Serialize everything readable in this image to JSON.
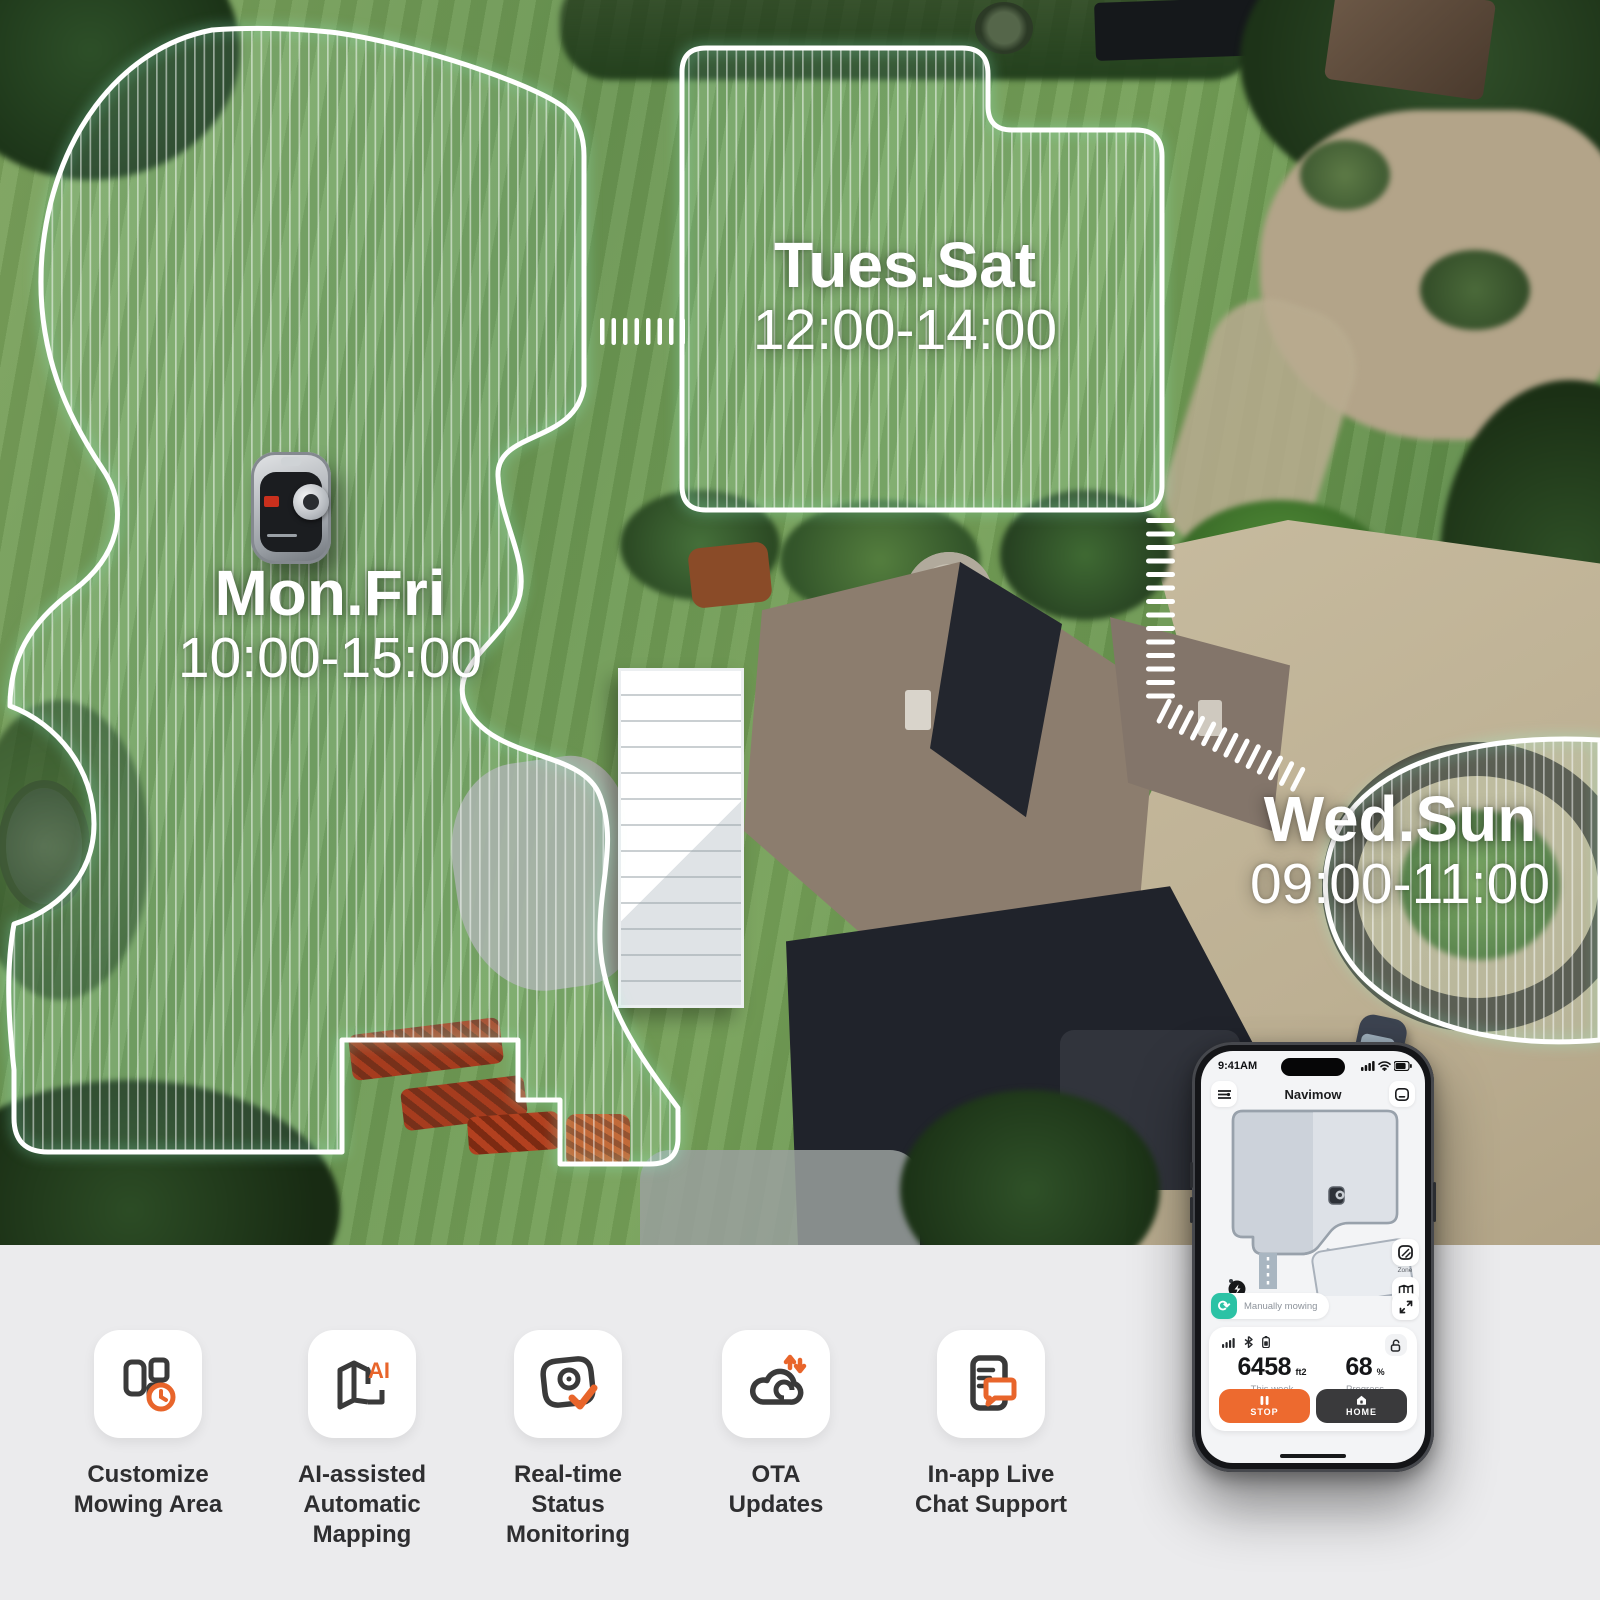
{
  "zones": [
    {
      "days": "Mon.Fri",
      "time": "10:00-15:00"
    },
    {
      "days": "Tues.Sat",
      "time": "12:00-14:00"
    },
    {
      "days": "Wed.Sun",
      "time": "09:00-11:00"
    }
  ],
  "phone": {
    "status_time": "9:41AM",
    "title": "Navimow",
    "map_buttons": {
      "zone": "Zone",
      "area": "2600㎡"
    },
    "status_pill": "Manually mowing",
    "stats": {
      "area_value": "6458",
      "area_unit": "ft2",
      "area_caption": "This week",
      "progress_value": "68",
      "progress_unit": "%",
      "progress_caption": "Progress"
    },
    "actions": {
      "stop": "STOP",
      "home": "HOME"
    }
  },
  "features": [
    {
      "icon": "zones-clock-icon",
      "lines": [
        "Customize",
        "Mowing Area"
      ]
    },
    {
      "icon": "ai-map-icon",
      "lines": [
        "AI-assisted",
        "Automatic",
        "Mapping"
      ]
    },
    {
      "icon": "camera-check-icon",
      "lines": [
        "Real-time",
        "Status",
        "Monitoring"
      ]
    },
    {
      "icon": "cloud-arrows-icon",
      "lines": [
        "OTA",
        "Updates"
      ]
    },
    {
      "icon": "doc-chat-icon",
      "lines": [
        "In-app Live",
        "Chat Support"
      ]
    }
  ],
  "colors": {
    "accent_orange": "#E8652B",
    "teal_status": "#2CC2A5",
    "dark_button": "#3A3A3C"
  }
}
